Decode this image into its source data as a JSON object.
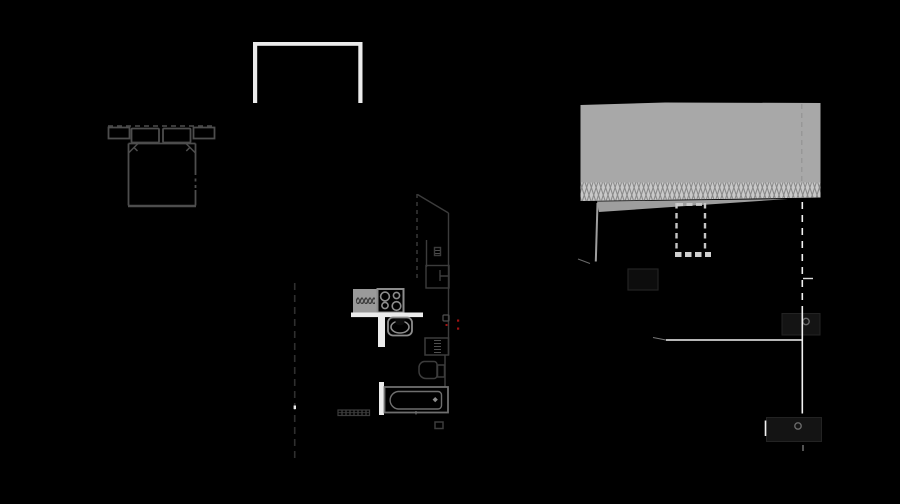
{
  "document": {
    "type": "architectural-drawing",
    "description": "Apartment floor plan (left) with roof construction section detail (right) drawn in gray and white line work on a black background",
    "background": "#000000",
    "width": 900,
    "height": 504
  },
  "colors": {
    "background": "#000000",
    "wall_white": "#ececec",
    "bright_line": "#f2f2f2",
    "plan_line": "#4d4d4d",
    "plan_dim": "#3c3c3c",
    "plan_line_light": "#6e6e6e",
    "fixture_gray": "#8c8c8c",
    "counter_fill": "#9a9a9a",
    "counter_hatch": "#3a3a3a",
    "slab_gray": "#a8a8a8",
    "insulation_bg": "#c9c9c9",
    "insulation_hatch": "#8a8a8a",
    "sliver_gray": "#9e9e9e",
    "duct_dash": "#c6c6c6",
    "duct_dash_light": "#d0d0d0",
    "dark_panel": "#141414",
    "dark_panel_edge": "#232323",
    "knob_gray": "#6a6a6a",
    "accent_red": "#a01212",
    "cut_line": "#2f2f2f"
  },
  "plan": {
    "walls": [
      "balcony-wall-top",
      "balcony-wall-left",
      "balcony-wall-right",
      "kitchen-wall-horizontal",
      "kitchen-wall-vertical",
      "bathroom-wall"
    ],
    "furniture": [
      "double-bed",
      "nightstand-left",
      "nightstand-right",
      "pillow-left",
      "pillow-right",
      "wardrobe",
      "fridge"
    ],
    "kitchen_fixtures": [
      "kitchen-counter",
      "cooktop-four-burners",
      "kitchen-sink-with-faucet"
    ],
    "bathroom_fixtures": [
      "washing-machine",
      "toilet",
      "bathtub-with-drain",
      "radiator",
      "floor-drain-square"
    ],
    "annotations": [
      "section-cut-line",
      "section-cut-marker",
      "red-outlet-dots",
      "junction-box"
    ]
  },
  "section": {
    "layers": [
      "roof-slab",
      "insulation-layer-zigzag-hatch",
      "ceiling-sliver",
      "wall-stud-wedge"
    ],
    "elements": [
      "dashed-duct",
      "dark-opening",
      "door-panel-upper",
      "door-knob-upper",
      "door-panel-lower",
      "door-knob-lower",
      "level-line-horizontal",
      "section-axis-dashed",
      "section-axis-solid",
      "dimension-tick",
      "threshold-dash"
    ]
  }
}
